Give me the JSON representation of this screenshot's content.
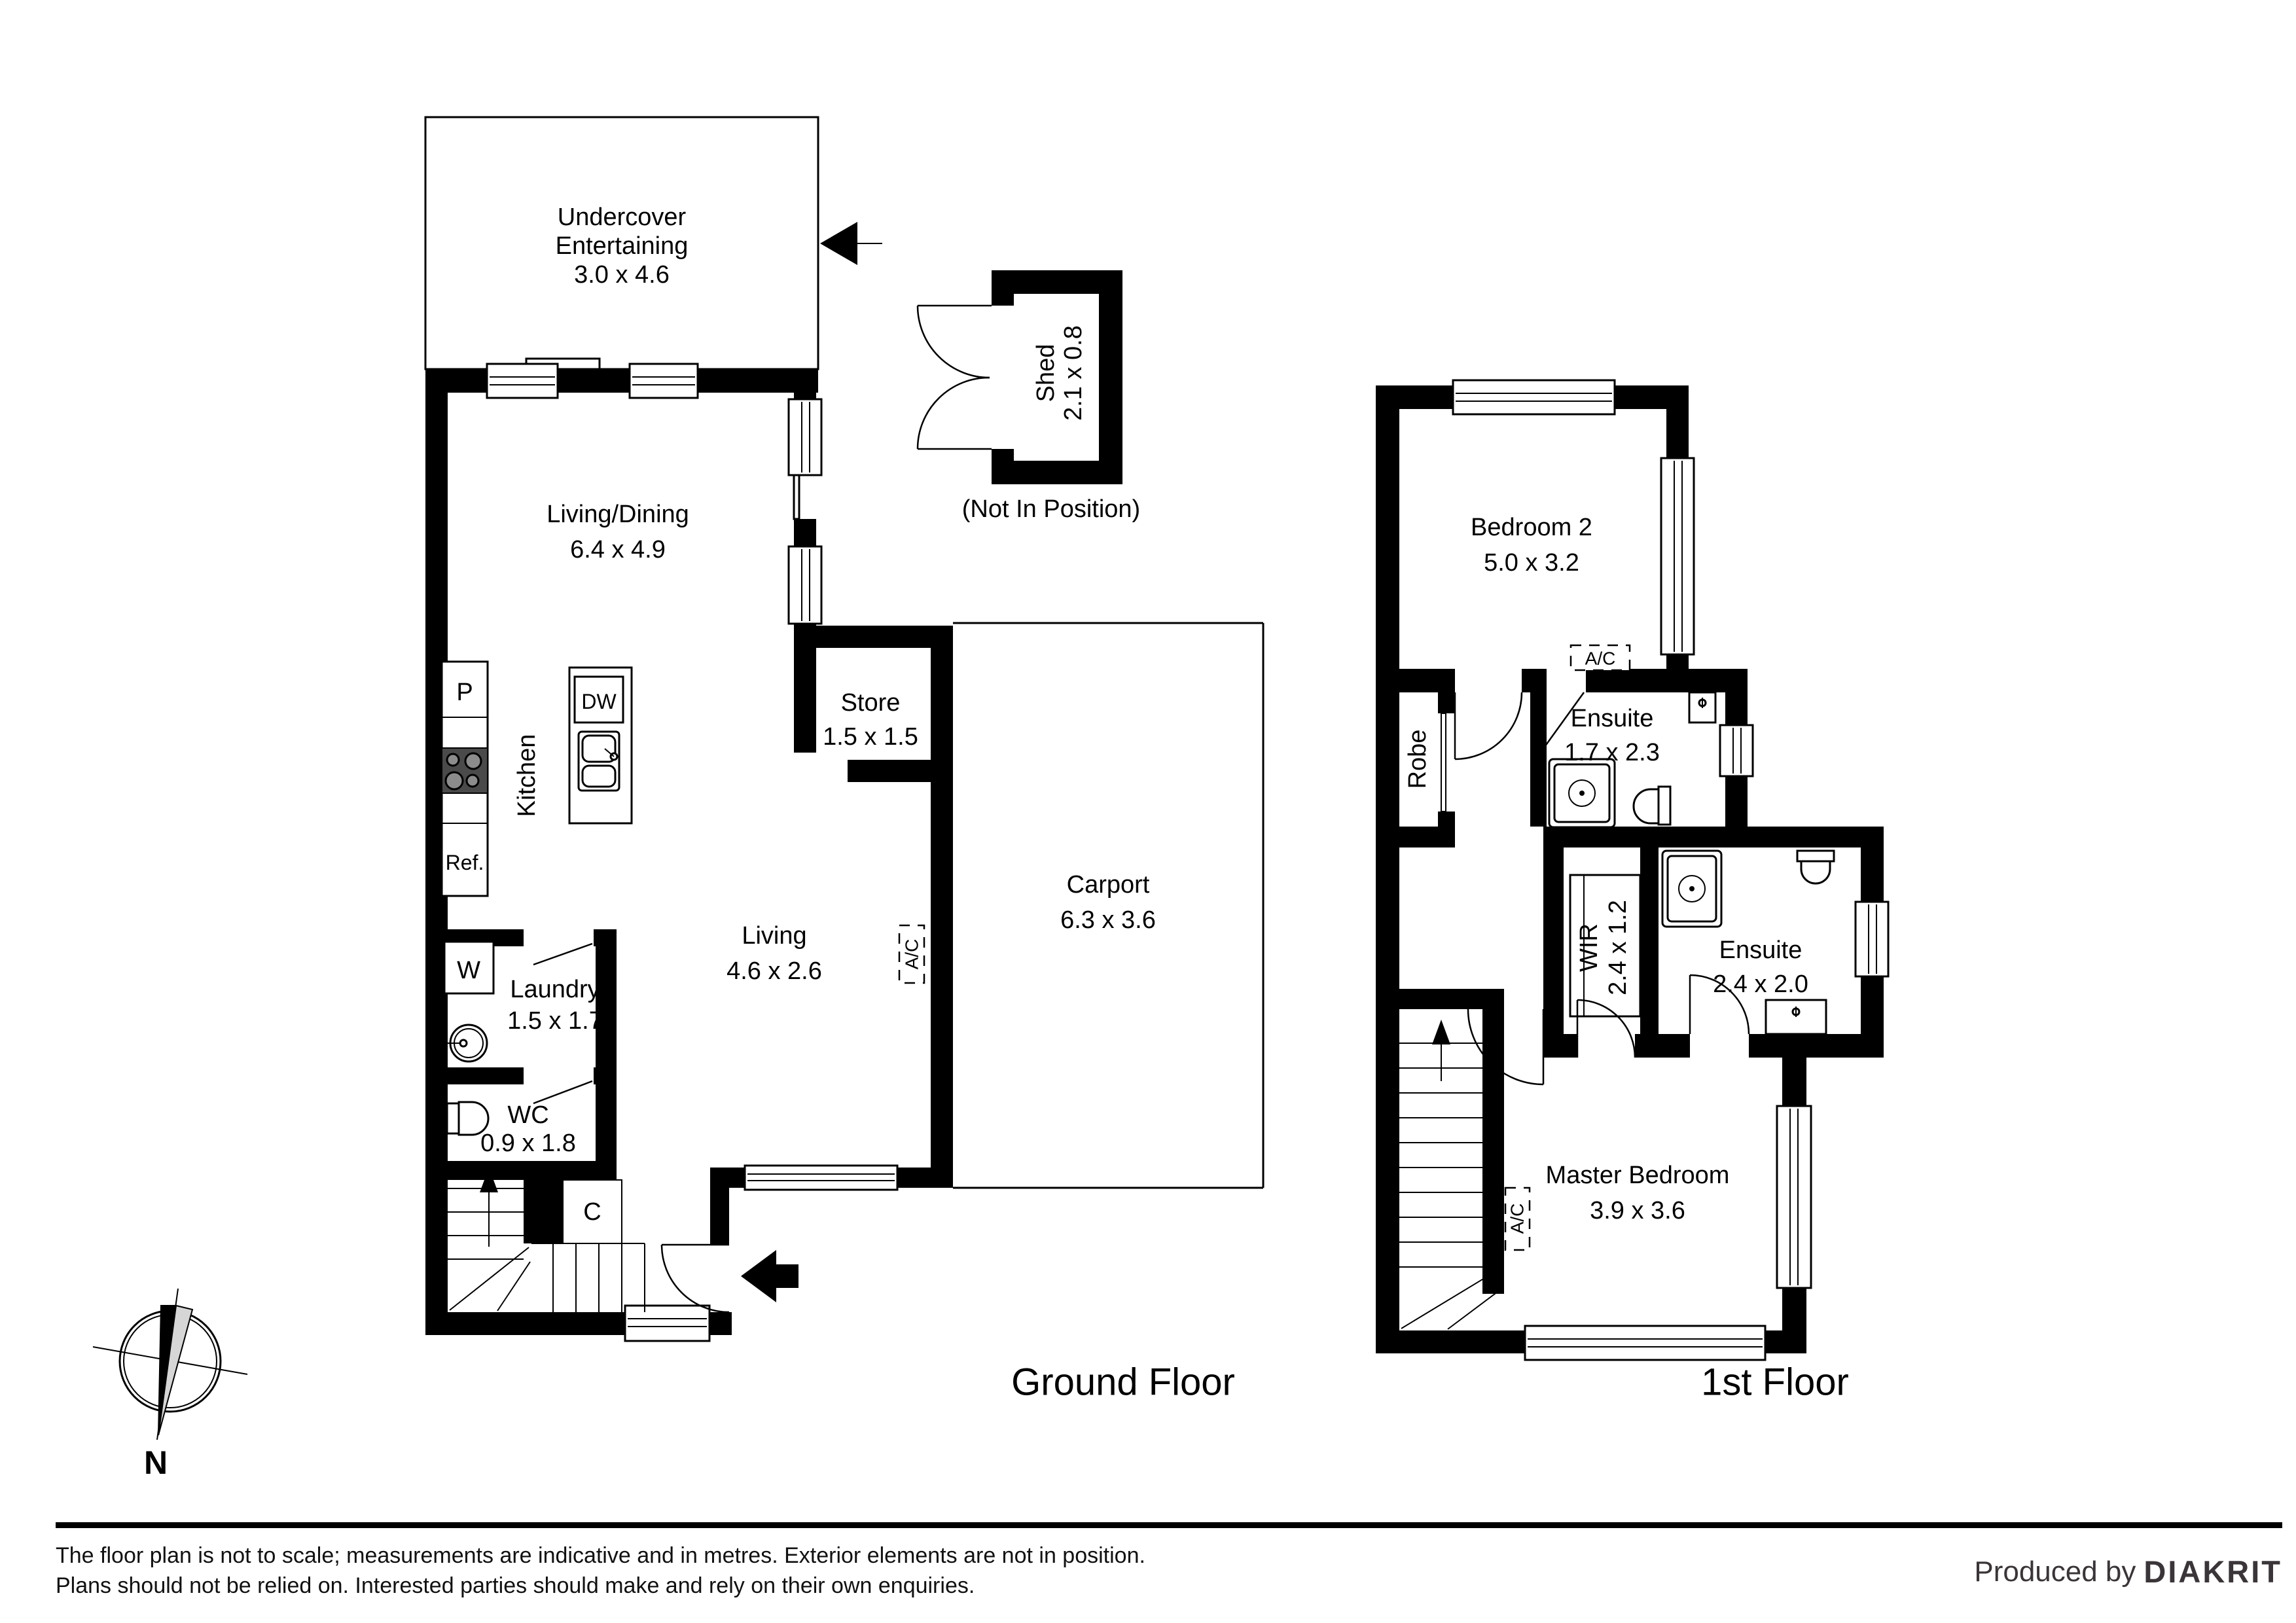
{
  "ground_floor": {
    "title": "Ground Floor",
    "rooms": {
      "undercover": {
        "line1": "Undercover",
        "line2": "Entertaining",
        "dims": "3.0 x 4.6"
      },
      "living_dining": {
        "name": "Living/Dining",
        "dims": "6.4 x 4.9"
      },
      "kitchen": {
        "name": "Kitchen"
      },
      "store": {
        "name": "Store",
        "dims": "1.5 x 1.5"
      },
      "carport": {
        "name": "Carport",
        "dims": "6.3 x 3.6"
      },
      "living": {
        "name": "Living",
        "dims": "4.6 x 2.6"
      },
      "laundry": {
        "name": "Laundry",
        "dims": "1.5 x 1.7"
      },
      "wc": {
        "name": "WC",
        "dims": "0.9 x 1.8"
      },
      "shed": {
        "name": "Shed",
        "dims": "2.1 x 0.8",
        "note": "(Not In Position)"
      }
    },
    "fixtures": {
      "pantry": "P",
      "dishwasher": "DW",
      "refrigerator": "Ref.",
      "washer": "W",
      "closet": "C",
      "ac": "A/C"
    }
  },
  "first_floor": {
    "title": "1st Floor",
    "rooms": {
      "bedroom2": {
        "name": "Bedroom 2",
        "dims": "5.0 x 3.2"
      },
      "robe": {
        "name": "Robe"
      },
      "ensuite1": {
        "name": "Ensuite",
        "dims": "1.7 x 2.3"
      },
      "wir": {
        "name": "WIR",
        "dims": "2.4 x 1.2"
      },
      "ensuite2": {
        "name": "Ensuite",
        "dims": "2.4 x 2.0"
      },
      "master": {
        "name": "Master Bedroom",
        "dims": "3.9 x 3.6"
      }
    },
    "fixtures": {
      "ac_ensuite": "A/C",
      "ac_stairs": "A/C"
    }
  },
  "compass": {
    "north_label": "N"
  },
  "footer": {
    "disclaimer_line1": "The floor plan is not to scale; measurements are indicative and in metres. Exterior elements are not in position.",
    "disclaimer_line2": "Plans should not be relied on. Interested parties should make and rely on their own enquiries.",
    "produced_by": "Produced by",
    "brand": "DIAKRIT"
  }
}
